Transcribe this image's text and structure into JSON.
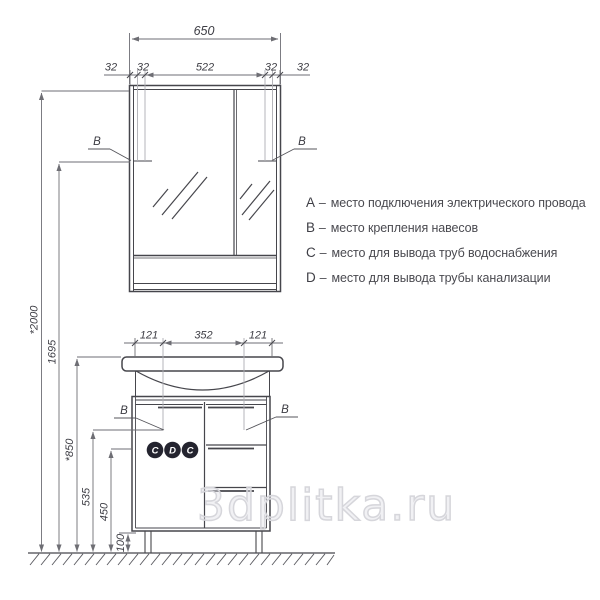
{
  "drawing": {
    "dims": {
      "mirror_width": "650",
      "mirror_top": [
        "32",
        "32",
        "522",
        "32",
        "32"
      ],
      "vanity_top": [
        "121",
        "352",
        "121"
      ],
      "heights": {
        "total": "*2000",
        "mirror_hinge": "1695",
        "vanity": "*850",
        "supply": "535",
        "drain": "450",
        "legs": "100"
      }
    },
    "markers": {
      "b": "B",
      "circles": [
        "C",
        "D",
        "C"
      ]
    },
    "colors": {
      "line": "#46464c",
      "dim": "#6e6e74",
      "guide": "#aeaeb4",
      "circle_fill": "#24242f",
      "circle_text": "#ffffff",
      "watermark": "#d6d6db"
    }
  },
  "legend": {
    "items": [
      {
        "key": "A",
        "dash": "–",
        "text": "место подключения электрического провода"
      },
      {
        "key": "B",
        "dash": "–",
        "text": "место крепления навесов"
      },
      {
        "key": "C",
        "dash": "–",
        "text": "место для вывода труб водоснабжения"
      },
      {
        "key": "D",
        "dash": "–",
        "text": "место для вывода трубы канализации"
      }
    ]
  },
  "watermark": "3dplitka.ru"
}
